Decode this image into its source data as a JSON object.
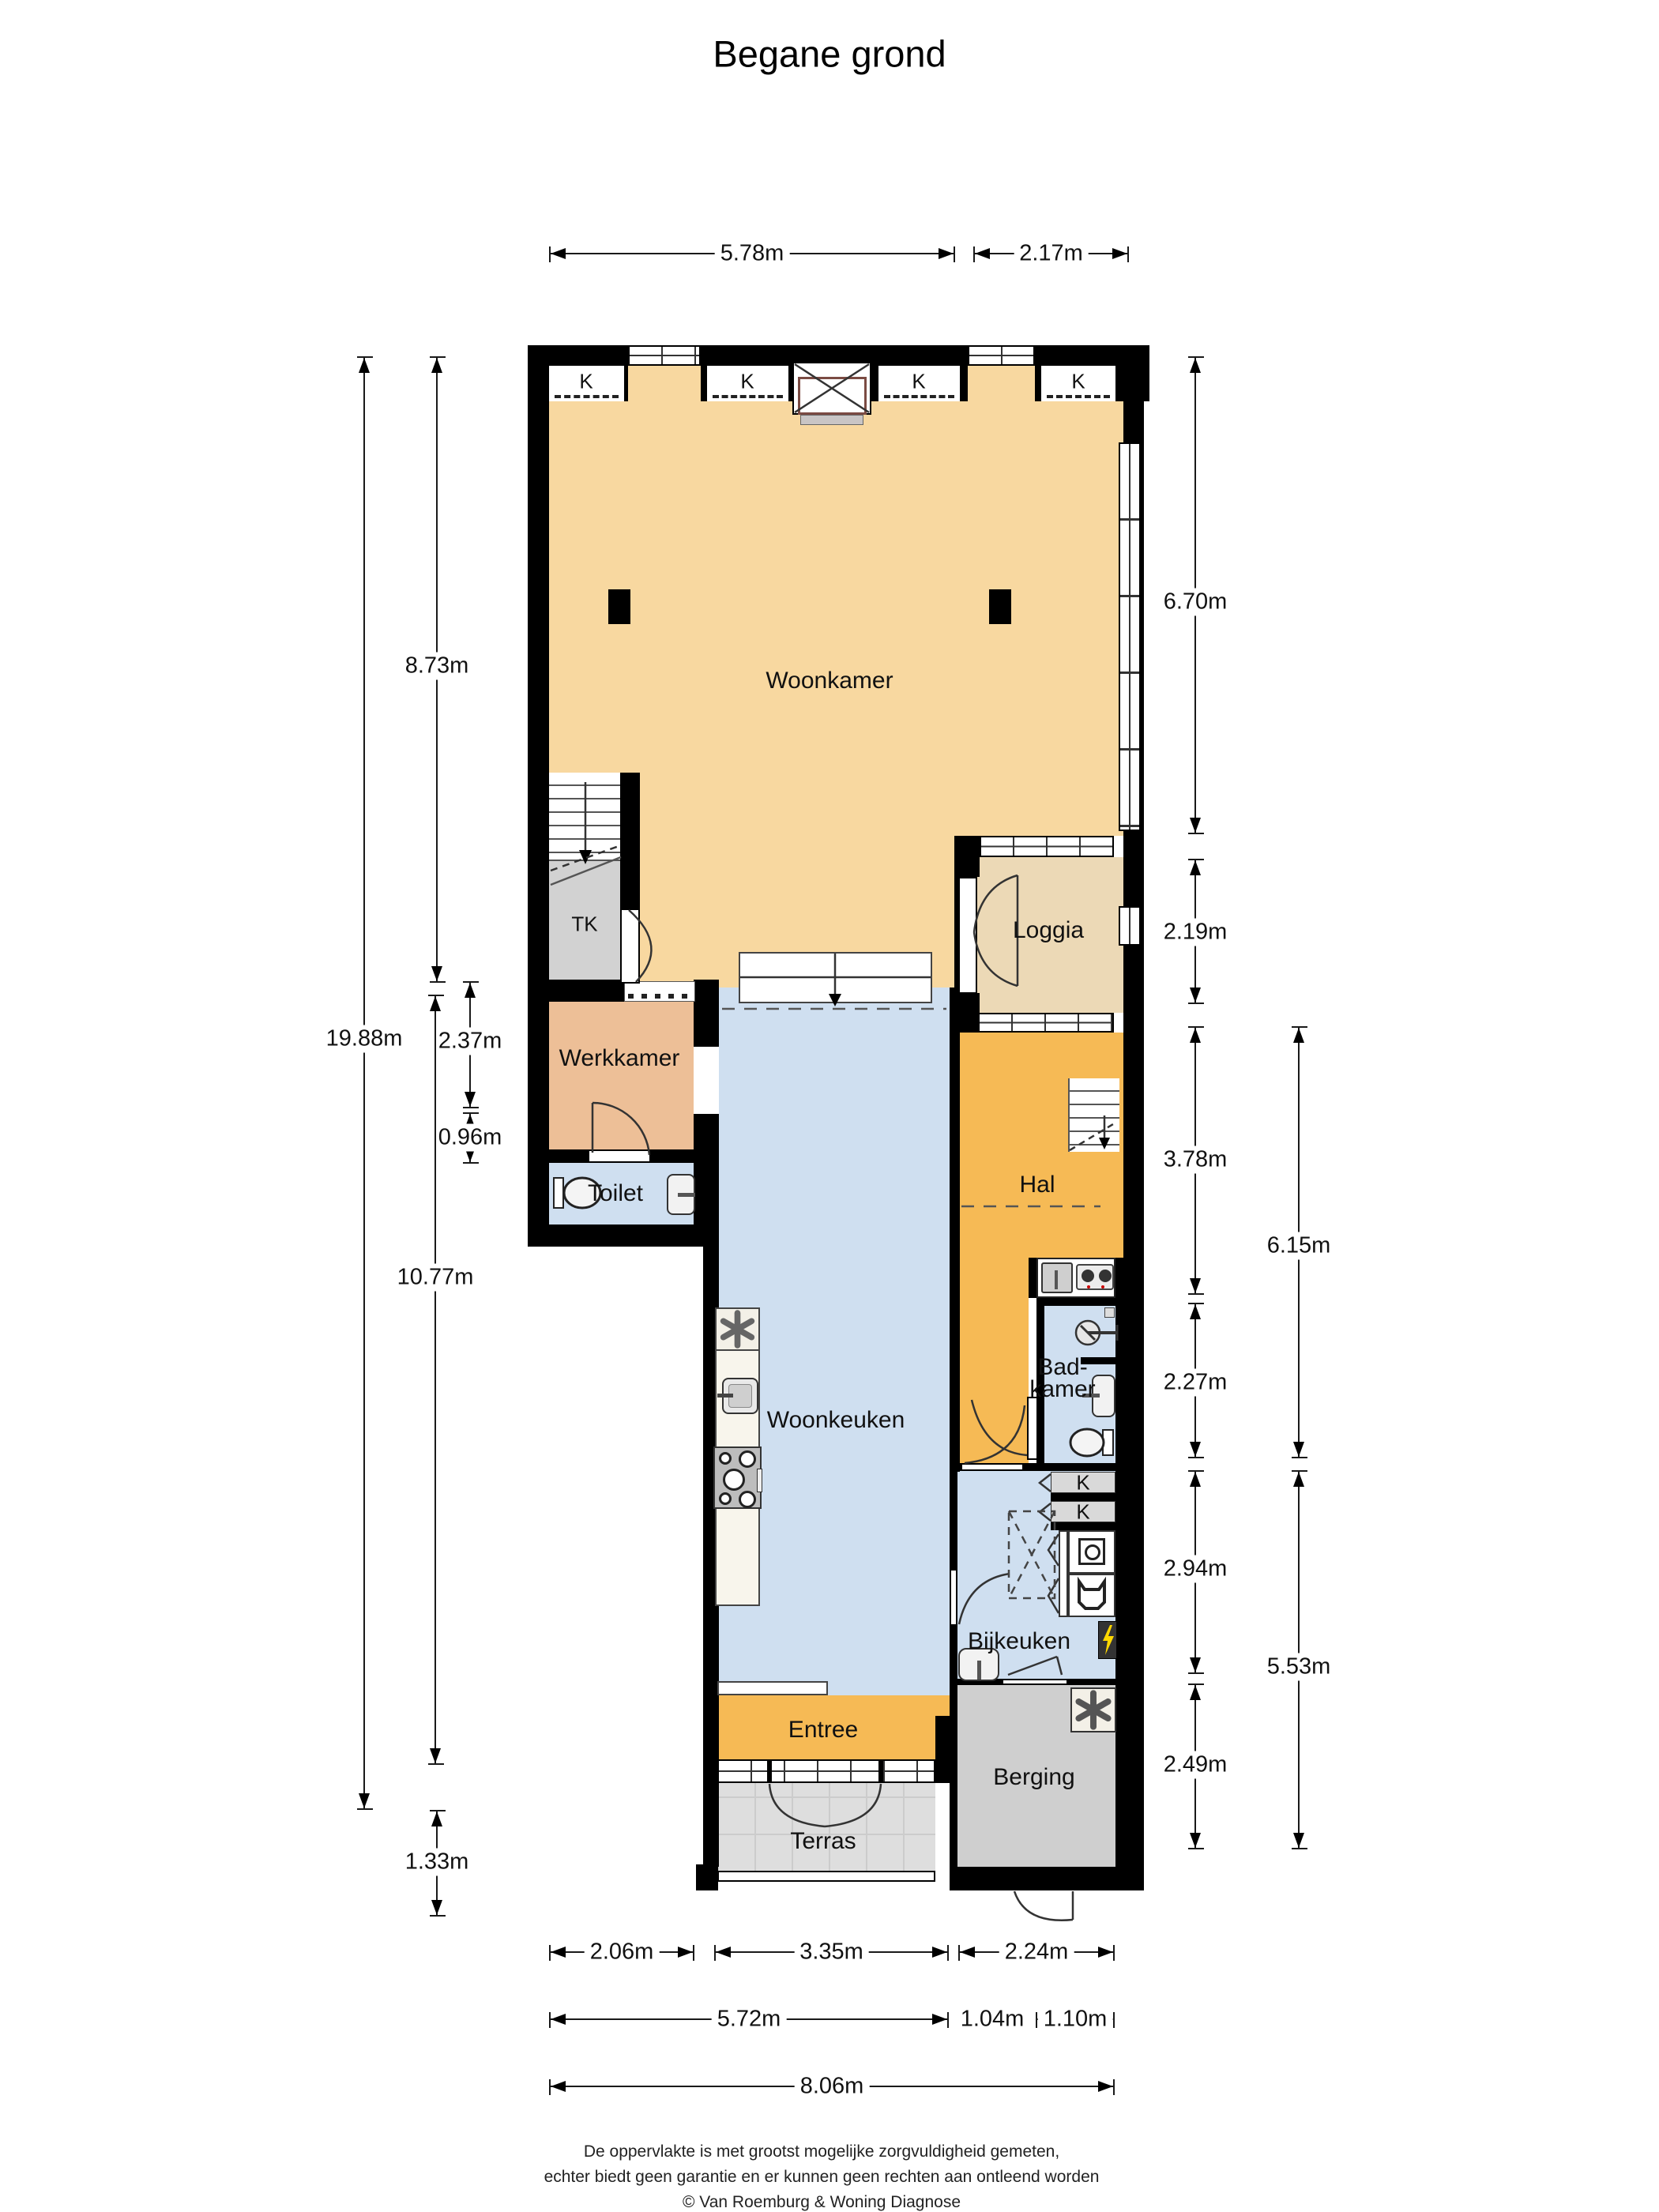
{
  "title": "Begane grond",
  "labels": {
    "k": "K"
  },
  "rooms": {
    "woonkamer": "Woonkamer",
    "loggia": "Loggia",
    "tk": "TK",
    "werkkamer": "Werkkamer",
    "toilet": "Toilet",
    "woonkeuken": "Woonkeuken",
    "hal": "Hal",
    "badkamer_line1": "Bad-",
    "badkamer_line2": "kamer",
    "bijkeuken": "Bijkeuken",
    "entree": "Entree",
    "terras": "Terras",
    "berging": "Berging"
  },
  "dims": {
    "top_1": "5.78m",
    "top_2": "2.17m",
    "left_total": "19.88m",
    "left_1": "8.73m",
    "left_2": "2.37m",
    "left_3": "0.96m",
    "left_4": "10.77m",
    "left_5": "1.33m",
    "right_1": "6.70m",
    "right_2": "2.19m",
    "right_3": "3.78m",
    "right_4": "2.27m",
    "right_5": "2.94m",
    "right_6": "2.49m",
    "right_outer_1": "6.15m",
    "right_outer_2": "5.53m",
    "bottom_r1_1": "2.06m",
    "bottom_r1_2": "3.35m",
    "bottom_r1_3": "2.24m",
    "bottom_r2_1": "5.72m",
    "bottom_r2_2": "1.04m",
    "bottom_r2_3": "1.10m",
    "bottom_r3_1": "8.06m"
  },
  "footer": {
    "line1": "De oppervlakte is met grootst mogelijke zorgvuldigheid gemeten,",
    "line2": "echter biedt geen garantie en er kunnen geen rechten aan ontleend worden",
    "line3": "© Van Roemburg & Woning Diagnose"
  },
  "colors": {
    "wall": "#000000",
    "woonkamer": "#f8d8a0",
    "loggia": "#ecd9b6",
    "hal_entree": "#f6ba55",
    "werkkamer": "#edbf97",
    "wet_rooms_blue": "#cfdff0",
    "storage_gray": "#d2d2d2",
    "terras_gray": "#dedede",
    "fireplace_accent": "#7b4b43",
    "meter_lightning": "#ffd800"
  },
  "icons": [
    "closet-k",
    "fireplace",
    "column",
    "stairs-down",
    "dishwasher-asterisk",
    "kitchen-sink",
    "stove-burners",
    "kitchenette-sink",
    "two-burner-stove",
    "shower-head",
    "extractor-fan",
    "washbasin",
    "toilet-bowl",
    "washing-machine",
    "dryer",
    "electric-meter-lightning",
    "freezer-asterisk",
    "door-swing",
    "french-doors"
  ]
}
